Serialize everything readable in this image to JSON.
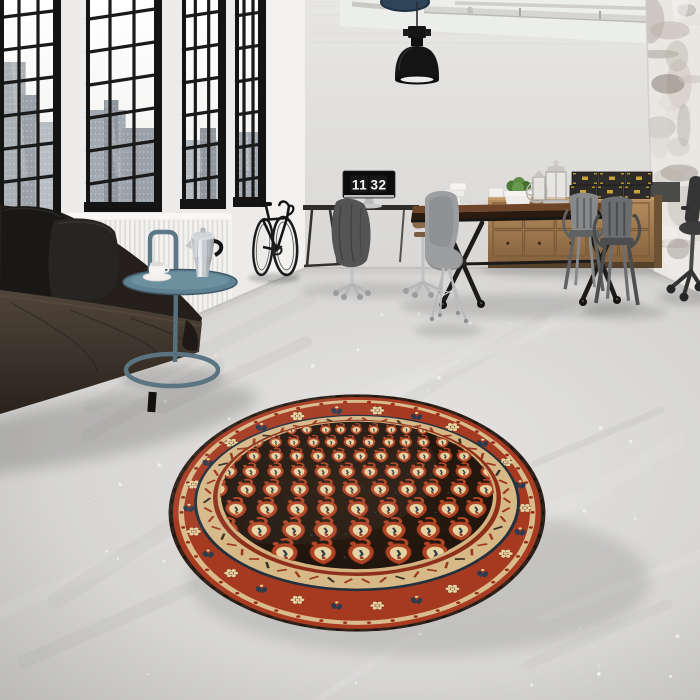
{
  "scene": {
    "description": "industrial loft interior with round oriental rug",
    "clock": {
      "hours": "11",
      "minutes": "32"
    },
    "palette": {
      "wall_back": "#dfdedc",
      "wall_left": "#ecebe9",
      "wall_corner": "#f2f1ef",
      "wall_right": "#eae7e3",
      "window_frame": "#161616",
      "sky": "#f7f7f6",
      "city_greys": [
        "#aab0b6",
        "#9aa1a8",
        "#b8bdc2",
        "#a2a9b0",
        "#b6bbc0",
        "#8f969d"
      ],
      "radiator": "#f3f2f0",
      "radiator_rib": "#dddcd9",
      "floor_light": "#e3e2e0",
      "floor_dark": "#bbbab8",
      "sofa_leather_hi": "#4a4036",
      "sofa_leather_lo": "#2b241e",
      "sofa_back": "#241f1a",
      "pillow_dark": "#191817",
      "pillow_mid": "#262523",
      "side_table_teal": "#5b7888",
      "moka_silver": "#d6dade",
      "moka_shadow": "#8d9398",
      "bike": "#1c1c1c",
      "desk": "#2e2d2c",
      "monitor_screen": "#0b0b0b",
      "monitor_silver": "#c0c1c2",
      "coat": "#555555",
      "eames_shell": "#9c9ea0",
      "tolix_grey": "#6b6e70",
      "tolix_light": "#87898b",
      "table_wood_top": "#6f452a",
      "table_wood_edge": "#2b1a10",
      "table_metal": "#1d1b19",
      "sideboard_wood_hi": "#b58d5f",
      "sideboard_wood_lo": "#8a6640",
      "box_black": "#2d2c2a",
      "box_latch": "#c9a23a",
      "plant_green": "#55803c",
      "pot_white": "#efedea",
      "lantern_silver": "#cfcdc9",
      "lamp_black": "#141414",
      "lamp_glow": "#edecea",
      "pipe_grey": "#d6d5d2",
      "duct_blue": "#2f4459",
      "rug_field": "#221710",
      "rug_red": "#a53a21",
      "rug_red_bright": "#b04526",
      "rug_cream": "#e6d2a0",
      "rug_band_cream": "#d7b988",
      "rug_navy": "#2c3b4e",
      "rug_edge_dark": "#30231b"
    },
    "windows": {
      "row_spacing": 33,
      "cols": 3,
      "bays": [
        {
          "x": 0,
          "w": 57,
          "sill": 214,
          "slope": -7,
          "buildings": [
            [
              0.0,
              0.45,
              62,
              0
            ],
            [
              0.38,
              0.3,
              95,
              1
            ],
            [
              0.62,
              0.38,
              122,
              2
            ]
          ]
        },
        {
          "x": 86,
          "w": 72,
          "sill": 206,
          "slope": -11,
          "buildings": [
            [
              0.05,
              0.5,
              110,
              3
            ],
            [
              0.5,
              0.48,
              128,
              1
            ],
            [
              0.25,
              0.2,
              100,
              5
            ]
          ]
        },
        {
          "x": 182,
          "w": 40,
          "sill": 203,
          "slope": -6,
          "buildings": [
            [
              0.08,
              0.84,
              140,
              4
            ],
            [
              0.45,
              0.4,
              128,
              5
            ]
          ]
        },
        {
          "x": 235,
          "w": 27,
          "sill": 201,
          "slope": -4,
          "buildings": [
            [
              0.1,
              0.8,
              132,
              3
            ]
          ]
        }
      ]
    },
    "radiator": {
      "x": 57,
      "y": 213,
      "w": 175,
      "h": 114,
      "ribs": 36
    },
    "rug": {
      "cx": 357,
      "cy": 513,
      "r": 188.5,
      "scale_y": 0.63,
      "boteh_rows": [
        [
          -132,
          0.55
        ],
        [
          -112,
          0.62
        ],
        [
          -90,
          0.7
        ],
        [
          -65,
          0.79
        ],
        [
          -37,
          0.89
        ],
        [
          -6,
          1.0
        ],
        [
          28,
          1.12
        ],
        [
          64,
          1.25
        ]
      ],
      "col_step": 30,
      "rosettes": 26,
      "zigzag_marks": 54,
      "rim_dots": 46,
      "edge_dashes": 64
    },
    "sideboard": {
      "x": 488,
      "y": 197,
      "w": 166,
      "h": 65,
      "cols": 5,
      "rows": 2
    },
    "boxes": {
      "x": 570,
      "y": 172,
      "cols": 3,
      "rows": 2,
      "bw": 26,
      "bh": 13
    },
    "floor": {
      "streaks": 16,
      "speckles": 46
    }
  }
}
